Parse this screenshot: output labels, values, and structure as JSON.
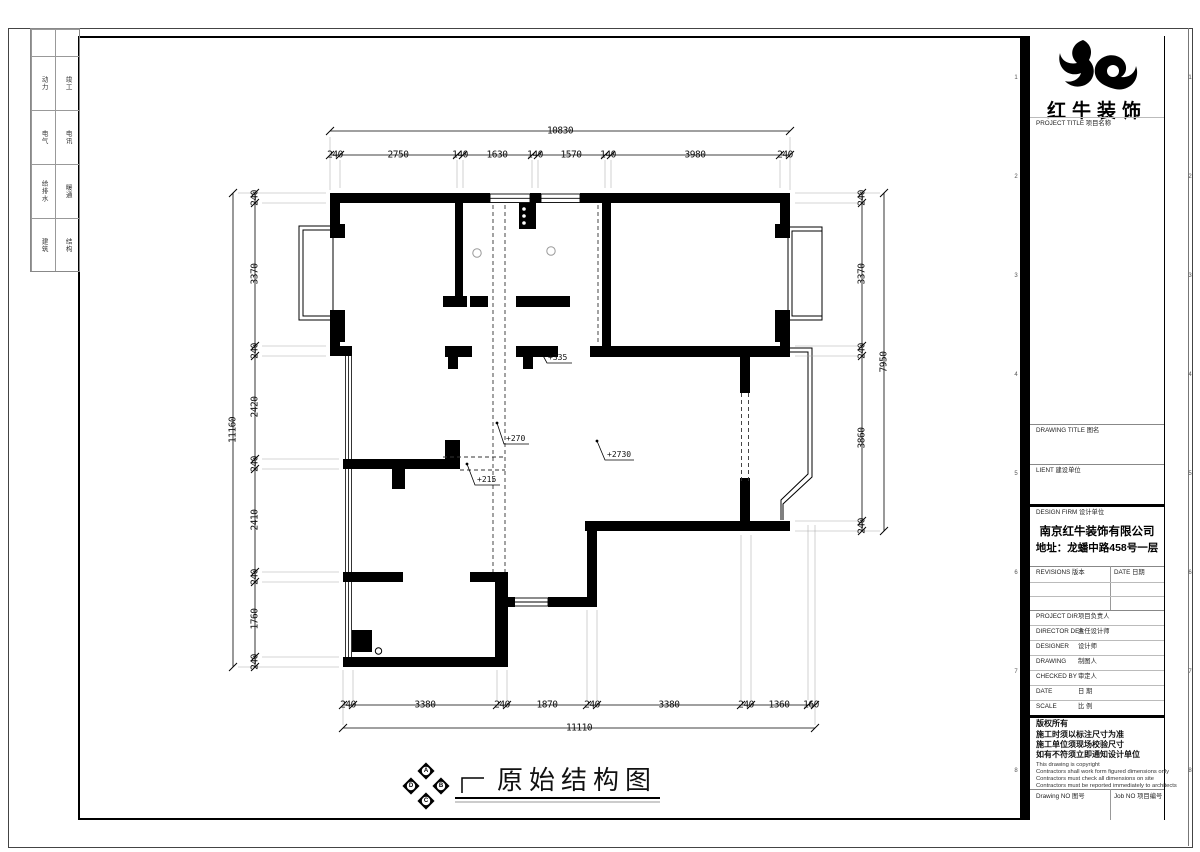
{
  "sheet": {
    "plan_title": "原始结构图",
    "levels": [
      "+335",
      "+270",
      "+215",
      "+2730"
    ],
    "compass": {
      "n": "A",
      "e": "B",
      "s": "C",
      "w": "D"
    },
    "grid_refs": [
      "1",
      "2",
      "3",
      "4",
      "5",
      "6",
      "7",
      "8"
    ],
    "side_strip": [
      [
        "动力",
        "竣工"
      ],
      [
        "电气",
        "电讯"
      ],
      [
        "给排水",
        "暖通"
      ],
      [
        "建筑",
        "结构"
      ]
    ],
    "dims": {
      "top_total": "10830",
      "top": [
        "240",
        "2750",
        "140",
        "1630",
        "140",
        "1570",
        "140",
        "3980",
        "240"
      ],
      "bottom_total": "11110",
      "bottom": [
        "240",
        "3380",
        "240",
        "1870",
        "240",
        "3380",
        "240",
        "1360",
        "160"
      ],
      "left_total": "11160",
      "left": [
        "240",
        "3370",
        "240",
        "2420",
        "240",
        "2410",
        "240",
        "1760",
        "240"
      ],
      "right_total": "7950",
      "right": [
        "240",
        "3370",
        "240",
        "3860",
        "240"
      ]
    }
  },
  "title_block": {
    "brand": "红牛装饰",
    "project_title_label": "PROJECT TITLE 项目名称",
    "drawing_title_label": "DRAWING TITLE 图名",
    "client_label": "LIENT 建设单位",
    "design_firm_label": "DESIGN FIRM 设计单位",
    "firm_name": "南京红牛装饰有限公司",
    "firm_address": "地址：龙蟠中路458号一层",
    "revisions_label": "REVISIONS 版本",
    "date_col_label": "DATE 日期",
    "rows": [
      {
        "en": "PROJECT DIR",
        "zh": "项目负责人"
      },
      {
        "en": "DIRECTOR DER",
        "zh": "主任设计师"
      },
      {
        "en": "DESIGNER",
        "zh": "设计师"
      },
      {
        "en": "DRAWING",
        "zh": "制图人"
      },
      {
        "en": "CHECKED BY",
        "zh": "审定人"
      },
      {
        "en": "DATE",
        "zh": "日  期"
      },
      {
        "en": "SCALE",
        "zh": "比  例"
      }
    ],
    "copyright_title": "版权所有",
    "copyright_zh": [
      "施工时须以标注尺寸为准",
      "施工单位须现场校验尺寸",
      "如有不符须立即通知设计单位"
    ],
    "copyright_en": [
      "This drawing is copyright",
      "Contractors shall work form figured dimensions only",
      "Contractors must check all dimensions on site",
      "Contractors must be reported immediately to architects"
    ],
    "drawing_no_label": "Drawing NO 图号",
    "job_no_label": "Job NO 项目编号"
  }
}
